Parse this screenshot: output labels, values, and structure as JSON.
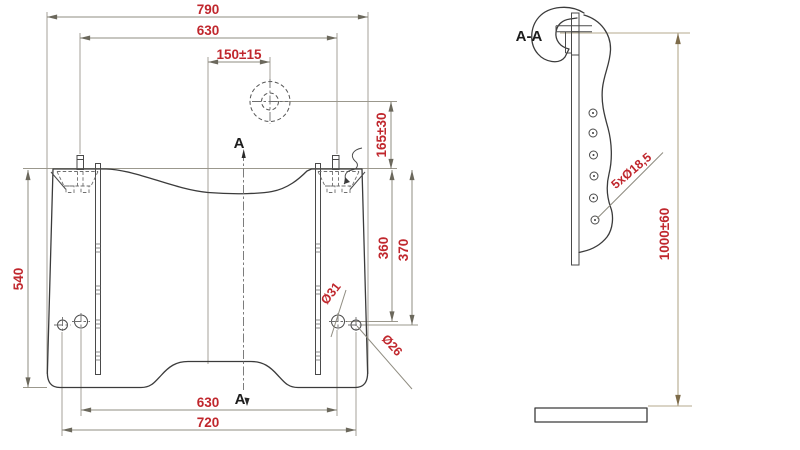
{
  "drawing": {
    "front_view": {
      "dim_width_overall": "790",
      "dim_pin_spacing_top": "630",
      "dim_hook_offset": "150±15",
      "dim_hook_drop": "165±30",
      "dim_hole_depth_1": "360",
      "dim_hole_depth_2": "370",
      "dim_height": "540",
      "dim_hole_spacing_bottom": "630",
      "dim_width_bottom": "720",
      "label_hole_large": "Ø31",
      "label_hole_small": "Ø26",
      "section_marker_top": "A",
      "section_marker_bottom": "A"
    },
    "section_view": {
      "title": "A-A",
      "label_holes": "5xØ18,5",
      "dim_height": "1000±60"
    },
    "colors": {
      "dimension_text": "#c0272d",
      "outline": "#3b3b3b",
      "dimension_line": "#8f8c80",
      "highlight_dimension_line": "#b5aa8d"
    }
  }
}
